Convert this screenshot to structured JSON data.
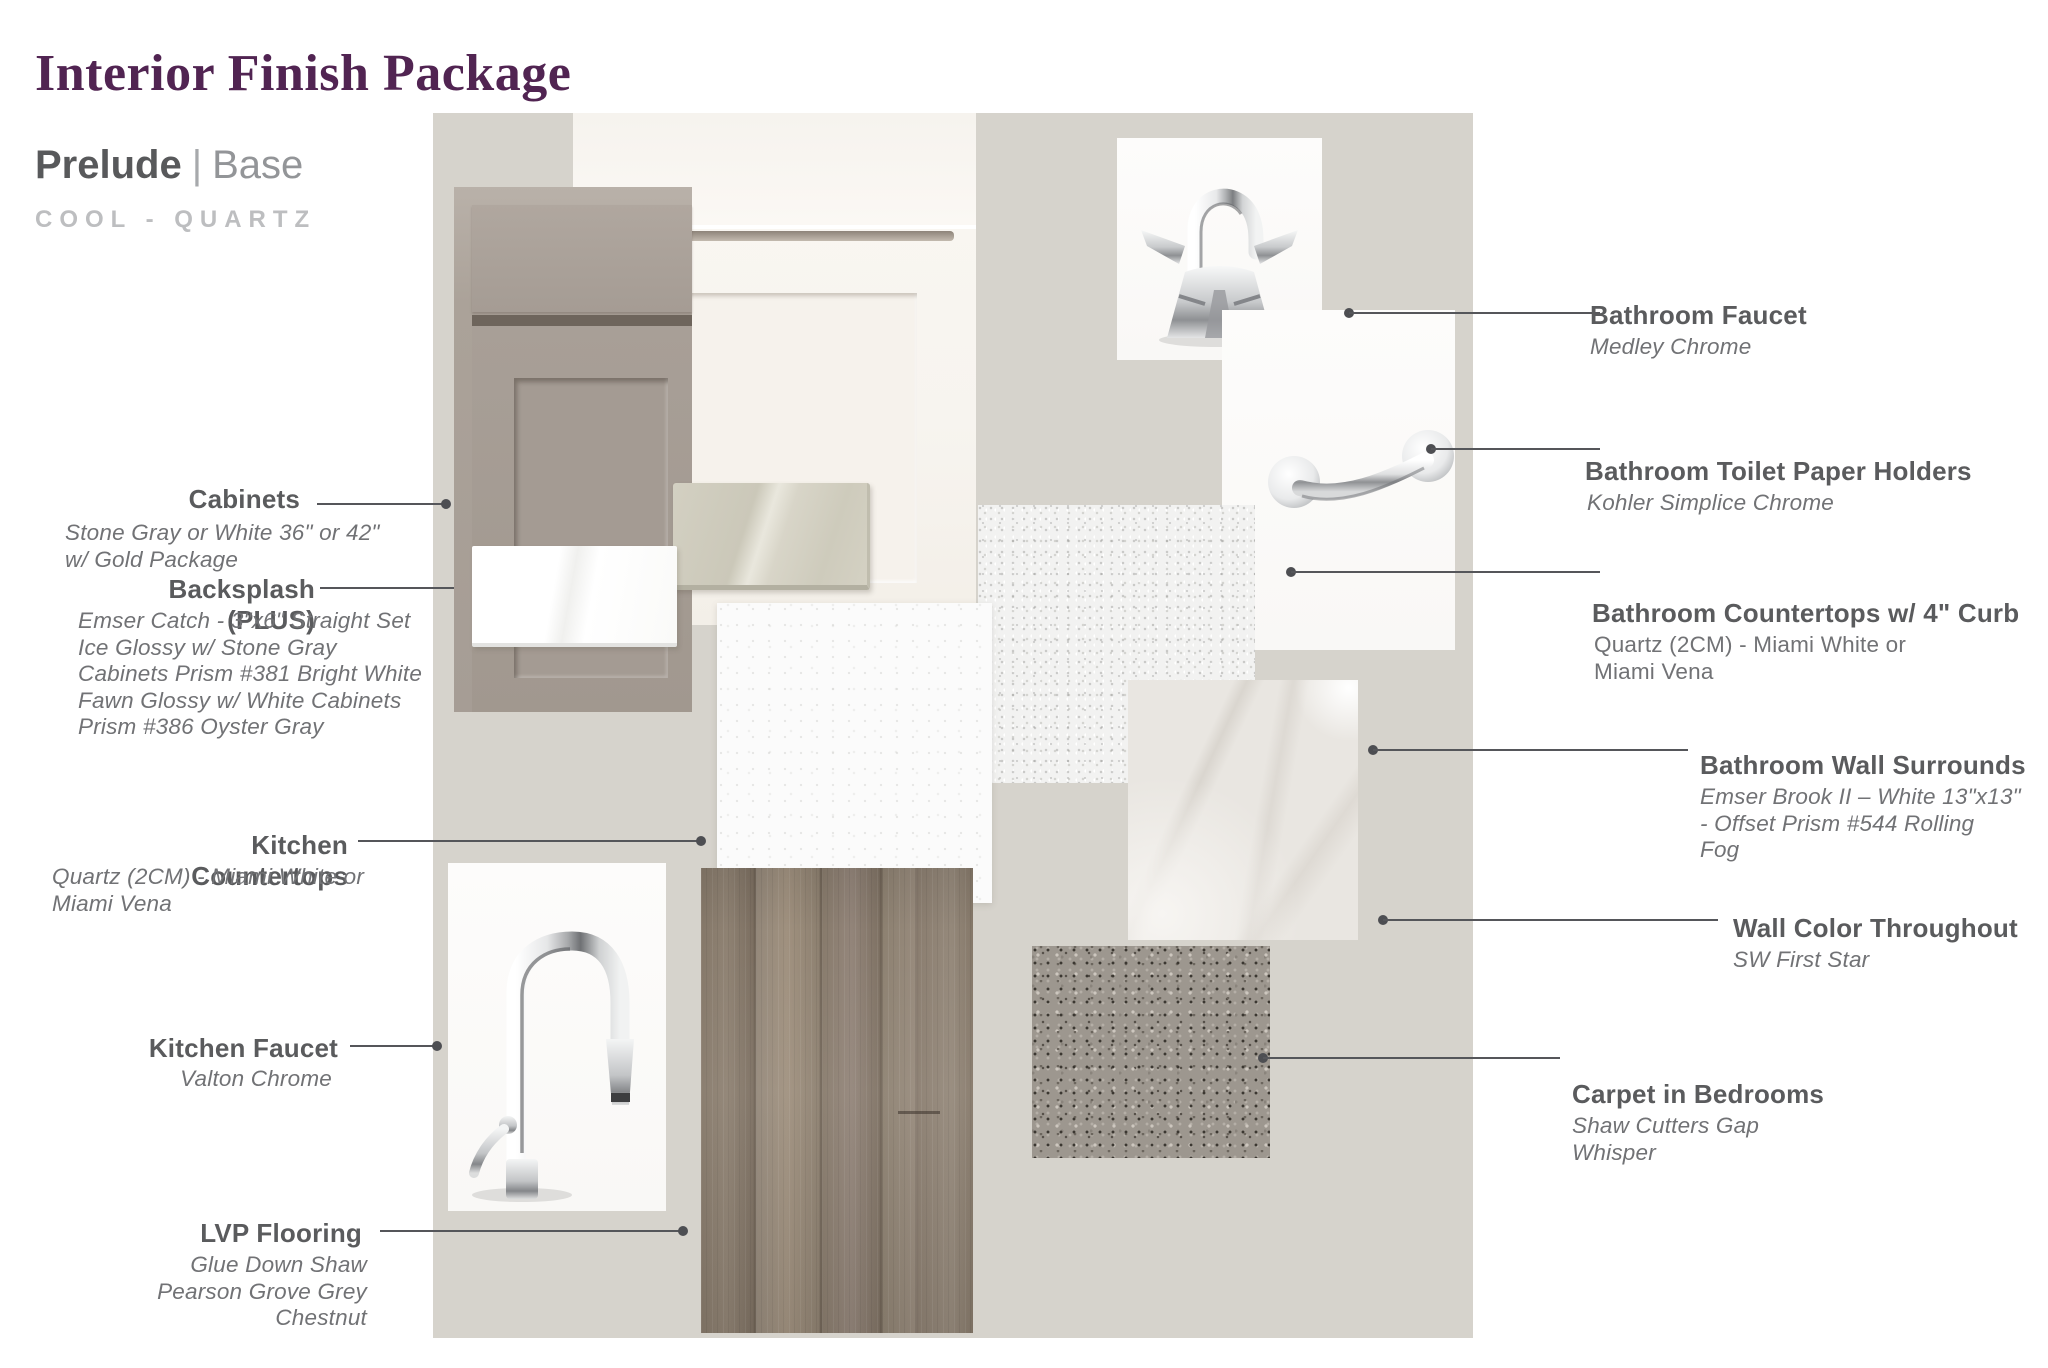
{
  "header": {
    "title": "Interior Finish Package",
    "series_name": "Prelude",
    "series_divider": "|",
    "series_tier": "Base",
    "palette": "COOL - QUARTZ"
  },
  "labels": {
    "cabinets": {
      "title": "Cabinets",
      "subtitle": "Stone Gray or White 36\" or 42\"\nw/ Gold Package"
    },
    "backsplash": {
      "title": "Backsplash (PLUS)",
      "subtitle": "Emser Catch - 3\"x6\" Straight Set\nIce Glossy w/ Stone Gray\nCabinets Prism #381 Bright White\nFawn Glossy w/ White Cabinets\nPrism #386 Oyster Gray"
    },
    "kitchen_countertops": {
      "title": "Kitchen Countertops",
      "subtitle": "Quartz (2CM)  - Miami White or\nMiami Vena"
    },
    "kitchen_faucet": {
      "title": "Kitchen Faucet",
      "subtitle": "Valton Chrome"
    },
    "lvp_flooring": {
      "title": "LVP Flooring",
      "subtitle": "Glue Down Shaw\nPearson Grove Grey\nChestnut"
    },
    "bathroom_faucet": {
      "title": "Bathroom Faucet",
      "subtitle": "Medley Chrome"
    },
    "tp_holders": {
      "title": "Bathroom Toilet Paper Holders",
      "subtitle": "Kohler Simplice Chrome"
    },
    "bathroom_countertops": {
      "title": "Bathroom Countertops w/ 4\" Curb",
      "subtitle": "Quartz (2CM)  - Miami White or\nMiami Vena"
    },
    "wall_surrounds": {
      "title": "Bathroom Wall Surrounds",
      "subtitle": "Emser Brook II – White 13\"x13\"\n-  Offset Prism #544 Rolling\nFog"
    },
    "wall_color": {
      "title": "Wall Color Throughout",
      "subtitle": "SW First Star"
    },
    "carpet": {
      "title": "Carpet in Bedrooms",
      "subtitle": "Shaw Cutters Gap\nWhisper"
    }
  },
  "colors": {
    "accent_purple": "#512452",
    "heading_gray": "#58595b",
    "heading_light_gray": "#939598",
    "palette_gray": "#bdbec0",
    "label_gray": "#5a5b5d",
    "subtitle_gray": "#717275",
    "connector_line": "#55565a",
    "wall_color_board": "#d6d3cc"
  }
}
